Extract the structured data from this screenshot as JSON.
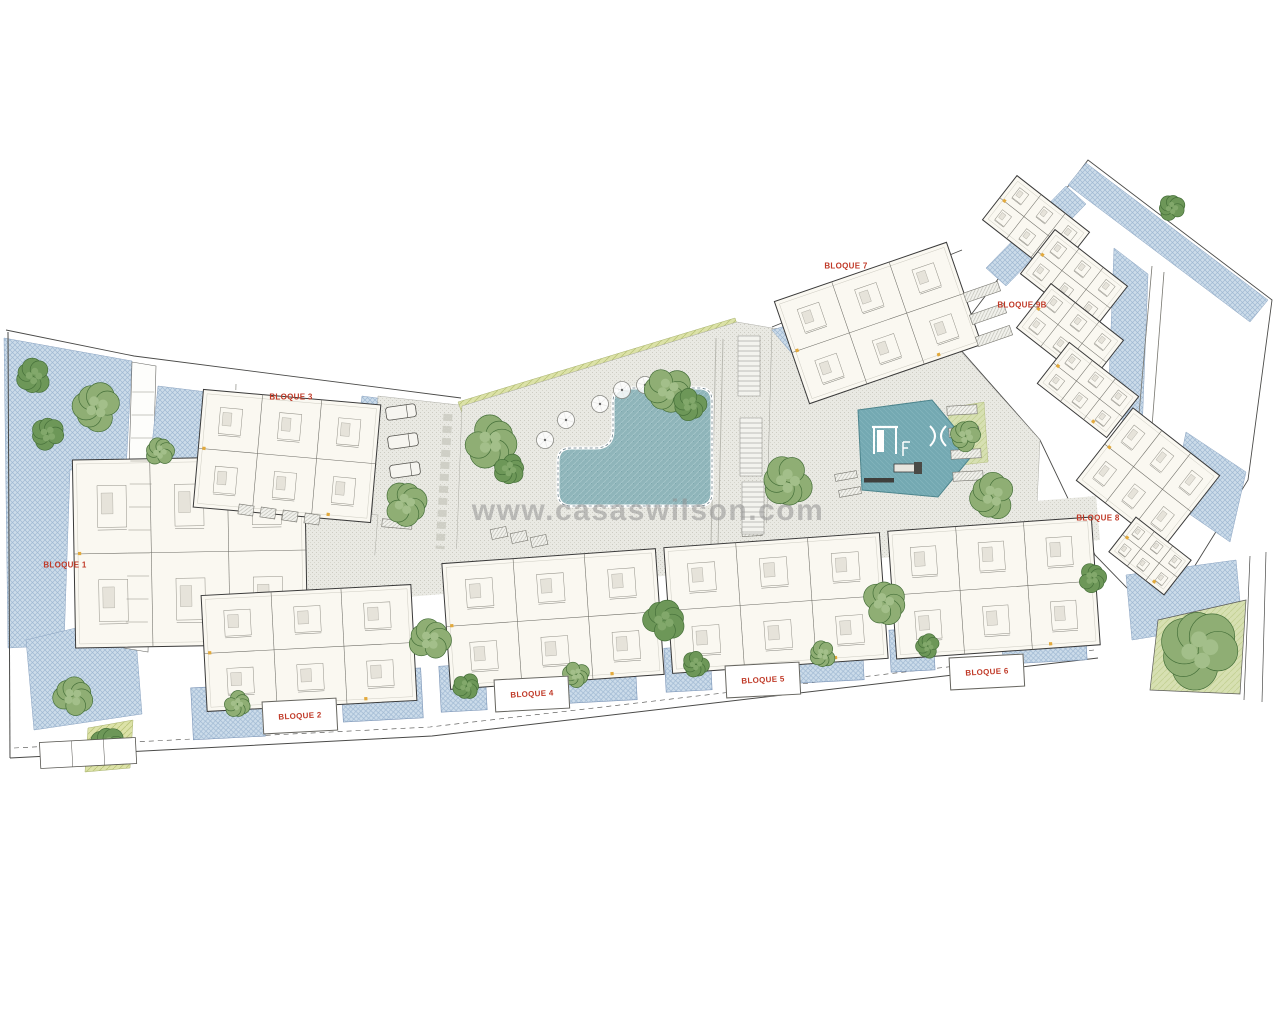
{
  "watermark": {
    "text": "www.casaswilson.com"
  },
  "labels": {
    "b1": "BLOQUE 1",
    "b2": "BLOQUE 2",
    "b3": "BLOQUE 3",
    "b4": "BLOQUE 4",
    "b5": "BLOQUE 5",
    "b6": "BLOQUE 6",
    "b7": "BLOQUE 7",
    "b8": "BLOQUE 8",
    "b9": "BLOQUE 9B"
  },
  "colors": {
    "label": "#c03a28",
    "accent": "#e2a93c",
    "watermark": "#8d8d8d",
    "outline": "#4a4a48",
    "hatch_blue": "#ccdcea",
    "plaza": "#e9e9e3",
    "pool": "#8fb5ba",
    "playground": "#74a9b2",
    "lawn": "#d7e0b2",
    "green_strip": "#dce2a8",
    "building": "#faf8f1",
    "wall": "#6b6a63",
    "furn": "#918f86",
    "patio_edge": "#7b94b6",
    "tree_dark": "#6d9758",
    "tree_dark_hi": "#82a86b",
    "tree_light": "#8fae74",
    "tree_light_hi": "#a3bf8a",
    "tree_edge": "#46703a"
  },
  "plan": {
    "trees": [
      [
        34,
        376,
        16,
        0
      ],
      [
        97,
        407,
        22,
        1
      ],
      [
        48,
        434,
        15,
        0
      ],
      [
        160,
        452,
        13,
        1
      ],
      [
        73,
        697,
        18,
        1
      ],
      [
        108,
        745,
        16,
        0
      ],
      [
        405,
        504,
        20,
        1
      ],
      [
        490,
        442,
        24,
        1
      ],
      [
        509,
        469,
        14,
        0
      ],
      [
        668,
        389,
        21,
        1
      ],
      [
        690,
        404,
        15,
        0
      ],
      [
        788,
        481,
        23,
        1
      ],
      [
        993,
        496,
        21,
        1
      ],
      [
        966,
        436,
        14,
        1
      ],
      [
        1172,
        208,
        12,
        0
      ],
      [
        430,
        640,
        19,
        1
      ],
      [
        664,
        621,
        19,
        0
      ],
      [
        884,
        603,
        20,
        1
      ],
      [
        1092,
        578,
        13,
        0
      ],
      [
        237,
        704,
        12,
        1
      ],
      [
        466,
        686,
        12,
        0
      ],
      [
        576,
        674,
        12,
        1
      ],
      [
        696,
        664,
        12,
        0
      ],
      [
        823,
        654,
        12,
        1
      ],
      [
        928,
        646,
        11,
        0
      ],
      [
        1200,
        650,
        36,
        1
      ]
    ],
    "buildings": [
      [
        190,
        552,
        232,
        188,
        -1
      ],
      [
        287,
        456,
        178,
        118,
        5
      ],
      [
        309,
        648,
        210,
        116,
        -3
      ],
      [
        553,
        619,
        214,
        126,
        -4
      ],
      [
        776,
        603,
        216,
        126,
        -4
      ],
      [
        994,
        588,
        204,
        128,
        -4
      ],
      [
        878,
        323,
        182,
        108,
        -19
      ],
      [
        1036,
        226,
        92,
        56,
        38
      ],
      [
        1074,
        280,
        92,
        56,
        38
      ],
      [
        1070,
        334,
        92,
        56,
        38
      ],
      [
        1088,
        390,
        88,
        52,
        38
      ],
      [
        1148,
        478,
        110,
        92,
        38
      ],
      [
        1150,
        556,
        70,
        44,
        38
      ]
    ],
    "patios": [
      [
        228,
        712,
        72,
        52
      ],
      [
        382,
        695,
        80,
        50
      ],
      [
        463,
        688,
        46,
        46
      ],
      [
        592,
        678,
        88,
        48
      ],
      [
        688,
        669,
        46,
        44
      ],
      [
        820,
        659,
        86,
        46
      ],
      [
        912,
        650,
        44,
        42
      ],
      [
        1044,
        640,
        84,
        44
      ]
    ],
    "parasols": [
      [
        545,
        440
      ],
      [
        566,
        420
      ],
      [
        600,
        404
      ],
      [
        622,
        390
      ],
      [
        645,
        385
      ]
    ]
  }
}
